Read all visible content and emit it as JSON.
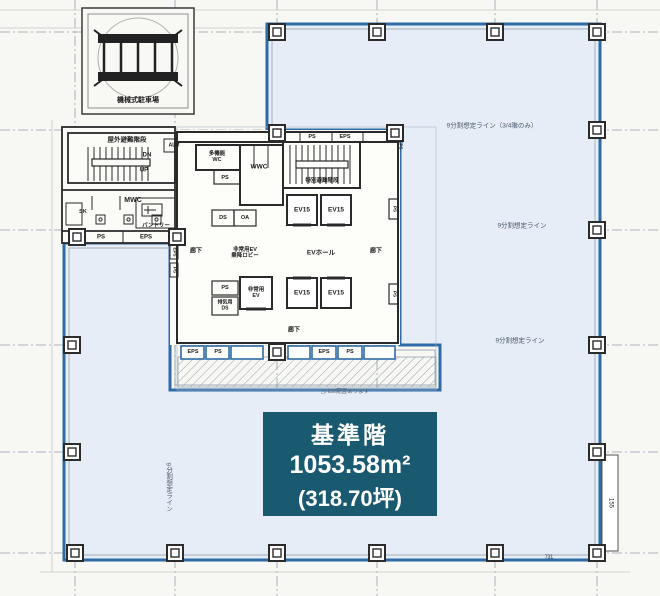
{
  "plan": {
    "info_box": {
      "title": "基準階",
      "area_m2": "1053.58m²",
      "area_tsubo": "(318.70坪)"
    },
    "rooms": {
      "parking": "機械式駐車場",
      "outdoor_stair": "屋外避難階段",
      "special_stair": "特別避難階段",
      "dn": "DN",
      "up": "UP",
      "alm": "ALM",
      "mwc": "MWC",
      "wwc": "WWC",
      "mf_wc_line1": "多機能",
      "mf_wc_line2": "WC",
      "sk": "SK",
      "pantry": "パントリー",
      "ev15": "EV15",
      "emg_ev_line1": "非常用",
      "emg_ev_line2": "EV",
      "emg_lobby_line1": "非常用EV",
      "emg_lobby_line2": "乗降ロビー",
      "ev_hall": "EVホール",
      "corridor": "廊下",
      "exhaust_line1": "排気用",
      "exhaust_line2": "DS",
      "ps": "PS",
      "eps": "EPS",
      "ds": "DS",
      "oa": "OA"
    },
    "annotations": {
      "partition_line_full": "9分割想定ライン（3/4階のみ）",
      "partition_line": "9分割想定ライン",
      "hatch_note": "△HD2配置あります",
      "dim_right": "155",
      "dim_bottom": "731"
    },
    "colors": {
      "boundary_blue": "#2e6ba6",
      "tenant_fill": "#e7edf6",
      "info_teal": "#1a5a70"
    }
  }
}
